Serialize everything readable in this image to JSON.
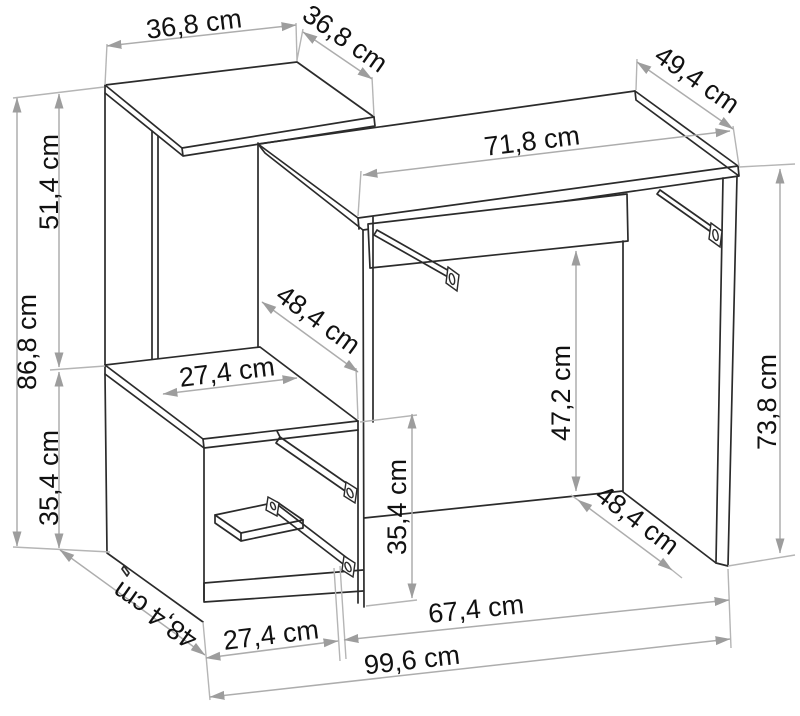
{
  "page": {
    "title": "Desk with shelf unit - dimension drawing",
    "background_color": "#ffffff",
    "structure_line_color": "#2b2b2b",
    "dimension_line_color": "#adadad",
    "label_color": "#111111",
    "unit": "cm"
  },
  "diagram": {
    "type": "furniture-dimension-drawing",
    "dimensions": {
      "top_shelf_width": {
        "label": "36,8 cm",
        "value": 36.8
      },
      "top_shelf_depth": {
        "label": "36,8 cm",
        "value": 36.8
      },
      "desktop_depth": {
        "label": "49,4 cm",
        "value": 49.4
      },
      "desktop_width": {
        "label": "71,8 cm",
        "value": 71.8
      },
      "left_unit_height": {
        "label": "86,8 cm",
        "value": 86.8
      },
      "upper_section_height": {
        "label": "51,4 cm",
        "value": 51.4
      },
      "lower_section_height": {
        "label": "35,4 cm",
        "value": 35.4
      },
      "middle_shelf_width": {
        "label": "27,4 cm",
        "value": 27.4
      },
      "upper_section_depth": {
        "label": "48,4 cm",
        "value": 48.4
      },
      "knee_clearance": {
        "label": "47,2 cm",
        "value": 47.2
      },
      "desk_height": {
        "label": "73,8 cm",
        "value": 73.8
      },
      "drawer_section_height": {
        "label": "35,4 cm",
        "value": 35.4
      },
      "side_panel_depth": {
        "label": "48,4 cm",
        "value": 48.4
      },
      "drawer_opening_width": {
        "label": "27,4 cm",
        "value": 27.4
      },
      "desk_opening_width": {
        "label": "67,4 cm",
        "value": 67.4
      },
      "total_width": {
        "label": "99,6 cm",
        "value": 99.6
      },
      "cabinet_depth": {
        "label": "48,4 cm",
        "value": 48.4
      }
    }
  }
}
